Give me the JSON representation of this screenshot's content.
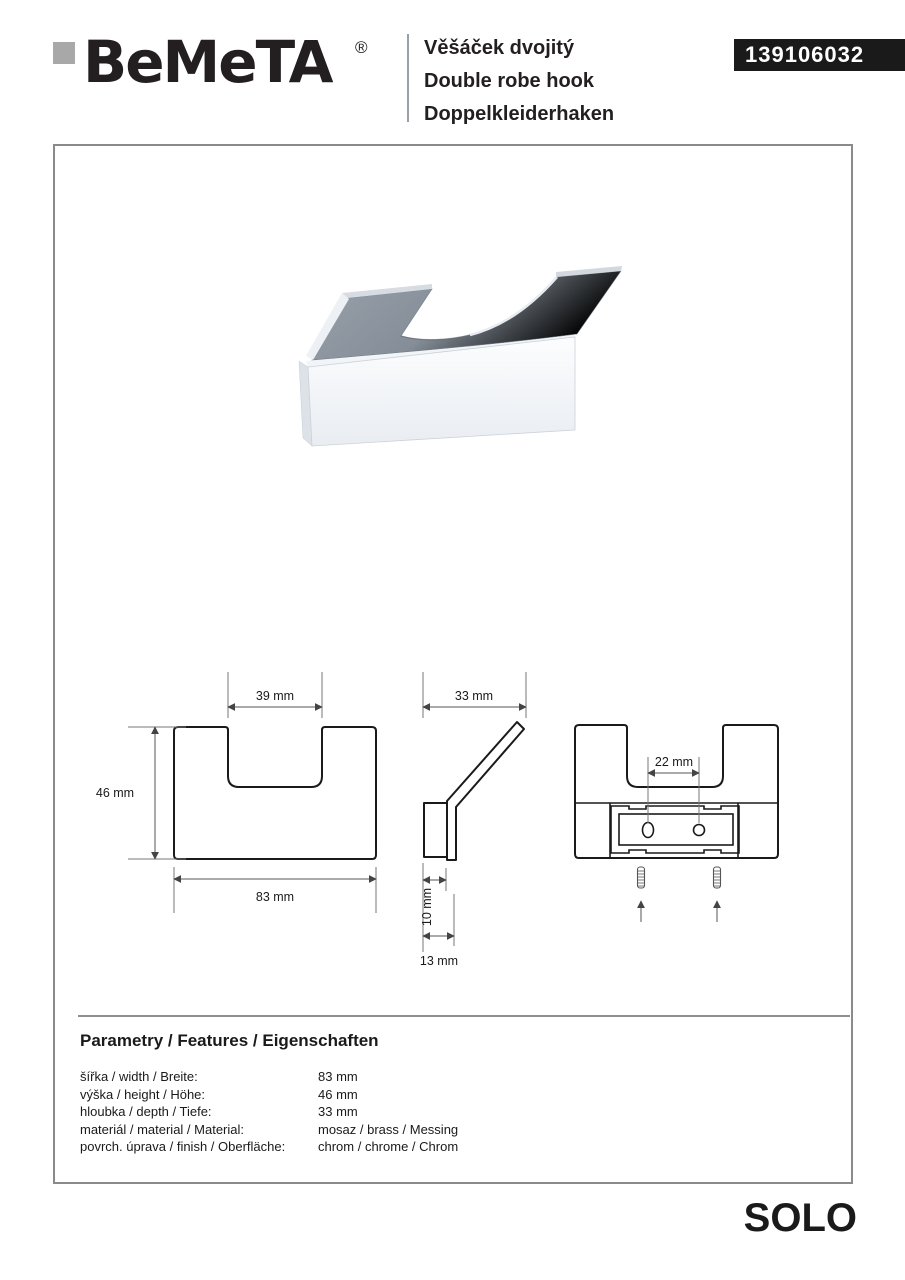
{
  "header": {
    "brand": "BeMeTA",
    "registered_mark": "®",
    "title_cs": "Věšáček dvojitý",
    "title_en": "Double robe hook",
    "title_de": "Doppelkleiderhaken",
    "product_code": "139106032"
  },
  "drawings": {
    "front_view": {
      "notch_width": "39 mm",
      "height": "46 mm",
      "width": "83 mm"
    },
    "side_view": {
      "depth": "33 mm",
      "base_depth": "10 mm",
      "total_depth": "13 mm"
    },
    "back_view": {
      "hole_spacing": "22 mm"
    }
  },
  "parameters": {
    "heading": "Parametry / Features / Eigenschaften",
    "rows": [
      {
        "label": "šířka / width / Breite:",
        "value": "83 mm"
      },
      {
        "label": "výška / height / Höhe:",
        "value": "46 mm"
      },
      {
        "label": "hloubka / depth / Tiefe:",
        "value": "33 mm"
      },
      {
        "label": "materiál / material / Material:",
        "value": "mosaz / brass / Messing"
      },
      {
        "label": "povrch. úprava / finish / Oberfläche:",
        "value": "chrom / chrome / Chrom"
      }
    ]
  },
  "footer": {
    "series": "SOLO"
  },
  "colors": {
    "badge_bg": "#1a1a1a",
    "brand_square_gray": "#a8a8a8",
    "frame_border_gray": "#8a8a8a",
    "chrome_gray": "#8b929b",
    "drawing_line": "#1a1a1a"
  }
}
